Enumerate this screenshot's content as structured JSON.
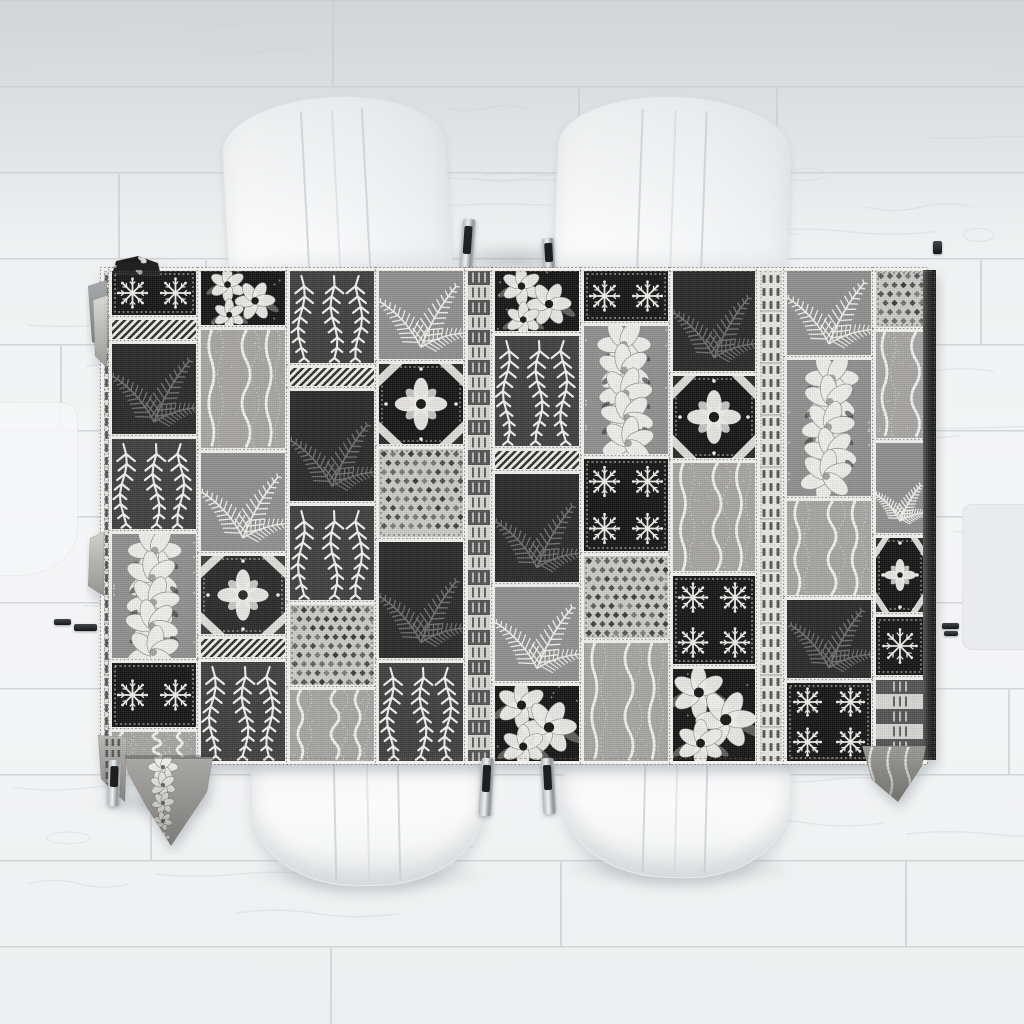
{
  "scene": {
    "width": 1024,
    "height": 1024,
    "subject": "black and white tropical patchwork tablecloth on a dining table with white chairs, viewed from directly above on a whitewashed wood plank floor"
  },
  "palette": {
    "floor_line": "#ccd1d4",
    "grain": "#d3d8db",
    "lace_base": "#ecebe7",
    "frame_white": "#f2f1ed",
    "frame_dot": "#6f6f6f",
    "side_band_light": "#565656",
    "side_band_dark": "#161616",
    "tones": {
      "K": "#161616",
      "C": "#2c2c2c",
      "D": "#404040",
      "S": "#6e6e6e",
      "M": "#8f8f8f",
      "G": "#a6a5a3",
      "L": "#cbcac6",
      "W": "#f0efeb",
      "F": "#f1f0ec"
    }
  },
  "floor": {
    "plank_pitch": 86,
    "grain_seed": 7,
    "joints": [
      [
        332,
        0
      ],
      [
        578,
        86
      ],
      [
        776,
        86
      ],
      [
        118,
        172
      ],
      [
        205,
        258
      ],
      [
        980,
        258
      ],
      [
        60,
        344
      ],
      [
        700,
        430
      ],
      [
        240,
        516
      ],
      [
        860,
        516
      ],
      [
        420,
        602
      ],
      [
        1008,
        688
      ],
      [
        150,
        774
      ],
      [
        560,
        860
      ],
      [
        905,
        860
      ],
      [
        330,
        946
      ]
    ]
  },
  "shadows": [
    {
      "x": 438,
      "y": 244,
      "w": 152,
      "h": 32
    },
    {
      "x": 246,
      "y": 856,
      "w": 244,
      "h": 36
    },
    {
      "x": 556,
      "y": 850,
      "w": 244,
      "h": 36
    },
    {
      "x": 90,
      "y": 790,
      "w": 130,
      "h": 26
    }
  ],
  "chairs": {
    "top_left": {
      "x": 224,
      "y": 96,
      "w": 222,
      "h": 182,
      "rot": -3,
      "kind": "chair-back",
      "seams": true
    },
    "top_right": {
      "x": 556,
      "y": 96,
      "w": 232,
      "h": 182,
      "rot": 2,
      "kind": "chair-back",
      "seams": true
    },
    "bottom_left": {
      "x": 252,
      "y": 752,
      "w": 230,
      "h": 132,
      "rot": -1.2,
      "kind": "chair-seat",
      "seams": true
    },
    "bottom_right": {
      "x": 562,
      "y": 756,
      "w": 226,
      "h": 120,
      "rot": 1.4,
      "kind": "chair-seat",
      "seams": true
    },
    "partial_left": {
      "x": -34,
      "y": 402,
      "w": 110,
      "h": 172,
      "rot": 0,
      "kind": "chair-partial-left",
      "seams": false
    },
    "partial_right": {
      "x": 962,
      "y": 504,
      "w": 70,
      "h": 144,
      "rot": 0,
      "kind": "chair-partial-right",
      "seams": false
    }
  },
  "legs": [
    {
      "x": 461,
      "y": 219,
      "w": 13,
      "h": 60,
      "rot": 4,
      "style": "chrome",
      "layer": "under"
    },
    {
      "x": 543,
      "y": 238,
      "w": 12,
      "h": 42,
      "rot": -3,
      "style": "chrome",
      "layer": "under"
    },
    {
      "x": 480,
      "y": 758,
      "w": 13,
      "h": 58,
      "rot": 3,
      "style": "chrome",
      "layer": "over"
    },
    {
      "x": 542,
      "y": 758,
      "w": 13,
      "h": 56,
      "rot": -3,
      "style": "chrome",
      "layer": "over"
    },
    {
      "x": 108,
      "y": 760,
      "w": 12,
      "h": 46,
      "rot": 2,
      "style": "chrome",
      "layer": "over"
    },
    {
      "x": 54,
      "y": 619,
      "w": 17,
      "h": 6,
      "rot": 0,
      "style": "dark",
      "layer": "over"
    },
    {
      "x": 74,
      "y": 624,
      "w": 23,
      "h": 7,
      "rot": 0,
      "style": "dark",
      "layer": "over"
    },
    {
      "x": 942,
      "y": 623,
      "w": 17,
      "h": 6,
      "rot": 0,
      "style": "dark",
      "layer": "over"
    },
    {
      "x": 944,
      "y": 631,
      "w": 14,
      "h": 5,
      "rot": 0,
      "style": "dark",
      "layer": "over"
    },
    {
      "x": 933,
      "y": 241,
      "w": 9,
      "h": 13,
      "rot": 0,
      "style": "dark",
      "layer": "over"
    }
  ],
  "tablecloth": {
    "svg": {
      "x": 86,
      "y": 255,
      "w": 860,
      "h": 600
    },
    "cloth_offset": [
      17,
      15
    ],
    "w": 833,
    "h": 490,
    "band_w": 13,
    "motif_legend": [
      "fern-frond",
      "willow-leaf-column",
      "lei-garland",
      "snowflake-quilt-block",
      "quilt-medallion",
      "wavy-dotted-lines",
      "lace-allover",
      "diagonal-hatch-strip",
      "ribbed-border-strip",
      "checkered-border-strip",
      "hibiscus-floral-cluster"
    ],
    "tiles": [
      [
        0,
        0,
        7,
        492,
        "rib",
        "F",
        "D"
      ],
      [
        8,
        0,
        86,
        46,
        "quilt",
        "K",
        "W"
      ],
      [
        8,
        49,
        86,
        21,
        "hatch",
        "W",
        "C"
      ],
      [
        8,
        73,
        86,
        92,
        "fern",
        "C",
        "S"
      ],
      [
        8,
        168,
        86,
        92,
        "leafcol",
        "D",
        "W"
      ],
      [
        8,
        263,
        86,
        126,
        "lei",
        "M",
        "W"
      ],
      [
        8,
        392,
        86,
        66,
        "quilt",
        "K",
        "W"
      ],
      [
        8,
        461,
        86,
        31,
        "waves",
        "G",
        "W"
      ],
      [
        97,
        0,
        86,
        56,
        "floral",
        "K",
        "W"
      ],
      [
        97,
        59,
        86,
        120,
        "waves",
        "G",
        "W"
      ],
      [
        97,
        182,
        86,
        100,
        "fern",
        "M",
        "W"
      ],
      [
        97,
        285,
        86,
        80,
        "medallion",
        "C",
        "W"
      ],
      [
        97,
        368,
        86,
        20,
        "hatch",
        "W",
        "C"
      ],
      [
        97,
        391,
        86,
        101,
        "leafcol",
        "D",
        "W"
      ],
      [
        186,
        0,
        86,
        94,
        "leafcol",
        "D",
        "W"
      ],
      [
        186,
        97,
        86,
        20,
        "hatch",
        "W",
        "C"
      ],
      [
        186,
        120,
        86,
        112,
        "fern",
        "C",
        "S"
      ],
      [
        186,
        235,
        86,
        96,
        "leafcol",
        "D",
        "W"
      ],
      [
        186,
        334,
        86,
        82,
        "lace",
        "L",
        "C"
      ],
      [
        186,
        419,
        86,
        73,
        "waves",
        "G",
        "W"
      ],
      [
        275,
        0,
        86,
        90,
        "fern",
        "M",
        "W"
      ],
      [
        275,
        93,
        86,
        82,
        "medallion",
        "K",
        "W"
      ],
      [
        275,
        178,
        86,
        90,
        "lace",
        "L",
        "C"
      ],
      [
        275,
        271,
        86,
        118,
        "fern",
        "C",
        "S"
      ],
      [
        275,
        392,
        86,
        100,
        "leafcol",
        "D",
        "W"
      ],
      [
        364,
        0,
        24,
        492,
        "check",
        "L",
        "D"
      ],
      [
        391,
        0,
        86,
        62,
        "floral",
        "K",
        "W"
      ],
      [
        391,
        65,
        86,
        112,
        "leafcol",
        "D",
        "W"
      ],
      [
        391,
        180,
        86,
        20,
        "hatch",
        "W",
        "C"
      ],
      [
        391,
        203,
        86,
        110,
        "fern",
        "C",
        "S"
      ],
      [
        391,
        316,
        86,
        96,
        "fern",
        "M",
        "W"
      ],
      [
        391,
        415,
        86,
        77,
        "floral",
        "K",
        "W"
      ],
      [
        480,
        0,
        86,
        52,
        "quilt",
        "K",
        "W"
      ],
      [
        480,
        55,
        86,
        130,
        "lei",
        "M",
        "W"
      ],
      [
        480,
        188,
        86,
        94,
        "quilt",
        "K",
        "W"
      ],
      [
        480,
        285,
        86,
        84,
        "lace",
        "L",
        "C"
      ],
      [
        480,
        372,
        86,
        120,
        "waves",
        "G",
        "W"
      ],
      [
        569,
        0,
        84,
        102,
        "fern",
        "C",
        "S"
      ],
      [
        569,
        105,
        84,
        84,
        "medallion",
        "K",
        "W"
      ],
      [
        569,
        192,
        84,
        110,
        "waves",
        "G",
        "W"
      ],
      [
        569,
        305,
        84,
        90,
        "quilt",
        "K",
        "W"
      ],
      [
        569,
        398,
        84,
        94,
        "floral",
        "K",
        "W"
      ],
      [
        656,
        0,
        24,
        492,
        "rib",
        "F",
        "D"
      ],
      [
        683,
        0,
        86,
        86,
        "fern",
        "M",
        "W"
      ],
      [
        683,
        89,
        86,
        138,
        "lei",
        "M",
        "W"
      ],
      [
        683,
        230,
        86,
        96,
        "waves",
        "G",
        "W"
      ],
      [
        683,
        329,
        86,
        80,
        "fern",
        "C",
        "S"
      ],
      [
        683,
        412,
        86,
        80,
        "quilt",
        "K",
        "W"
      ],
      [
        772,
        0,
        50,
        58,
        "lace",
        "L",
        "C"
      ],
      [
        772,
        61,
        50,
        108,
        "waves",
        "G",
        "W"
      ],
      [
        772,
        172,
        50,
        92,
        "fern",
        "M",
        "W"
      ],
      [
        772,
        267,
        50,
        76,
        "medallion",
        "K",
        "W"
      ],
      [
        772,
        346,
        50,
        60,
        "quilt",
        "K",
        "W"
      ],
      [
        772,
        409,
        50,
        83,
        "check",
        "L",
        "D"
      ]
    ],
    "flaps": [
      {
        "name": "corner-fold-gray",
        "points": [
          [
            2,
            31
          ],
          [
            21,
            25
          ],
          [
            23,
            93
          ],
          [
            6,
            87
          ]
        ],
        "fill": "#a6aaac",
        "deco": "none"
      },
      {
        "name": "corner-fold-light",
        "points": [
          [
            7,
            45
          ],
          [
            22,
            40
          ],
          [
            21,
            113
          ],
          [
            9,
            101
          ]
        ],
        "fill": "#d9d9d6",
        "deco": "none"
      },
      {
        "name": "corner-blob",
        "points": [
          [
            26,
            19
          ],
          [
            30,
            6
          ],
          [
            52,
            1
          ],
          [
            72,
            8
          ],
          [
            75,
            21
          ]
        ],
        "fill": "#1d1d1d",
        "deco": "dots"
      },
      {
        "name": "left-fold",
        "points": [
          [
            4,
            283
          ],
          [
            18,
            277
          ],
          [
            18,
            341
          ],
          [
            2,
            331
          ]
        ],
        "fill": "#cfcfcc",
        "deco": "none"
      },
      {
        "name": "bottom-left-corner-flap",
        "points": [
          [
            12,
            480
          ],
          [
            41,
            482
          ],
          [
            39,
            547
          ],
          [
            15,
            524
          ]
        ],
        "fill": "#b7b6b3",
        "deco": "bars"
      },
      {
        "name": "bottom-left-flap",
        "points": [
          [
            39,
            502
          ],
          [
            127,
            502
          ],
          [
            121,
            537
          ],
          [
            85,
            591
          ],
          [
            60,
            551
          ],
          [
            42,
            518
          ]
        ],
        "fill": "#a9a8a5",
        "deco": "lei"
      },
      {
        "name": "bottom-right-flap",
        "points": [
          [
            776,
            491
          ],
          [
            840,
            491
          ],
          [
            836,
            511
          ],
          [
            812,
            547
          ],
          [
            786,
            525
          ]
        ],
        "fill": "#9a9996",
        "deco": "waves"
      }
    ]
  }
}
